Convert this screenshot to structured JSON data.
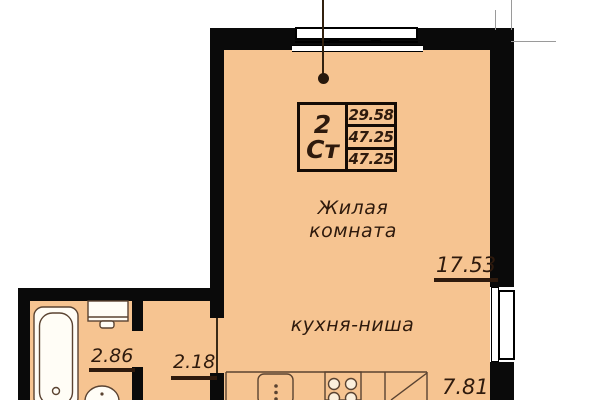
{
  "plan": {
    "unit_label": {
      "rooms": "2",
      "type": "Ст",
      "area_row1": "29.58",
      "area_row2": "47.25",
      "area_row3": "47.25"
    },
    "rooms": {
      "living": {
        "name_line1": "Жилая",
        "name_line2": "комната",
        "area": "17.53"
      },
      "kitchen": {
        "name": "кухня-ниша",
        "area": "7.81"
      },
      "bathroom": {
        "area": "2.86"
      },
      "hallway": {
        "area": "2.18"
      }
    },
    "colors": {
      "floor": "#F6C491",
      "wall": "#0A0A0A",
      "text": "#2E1A0D",
      "fixture": "#5A4331",
      "fixture_fill": "#FFFDF6"
    }
  }
}
